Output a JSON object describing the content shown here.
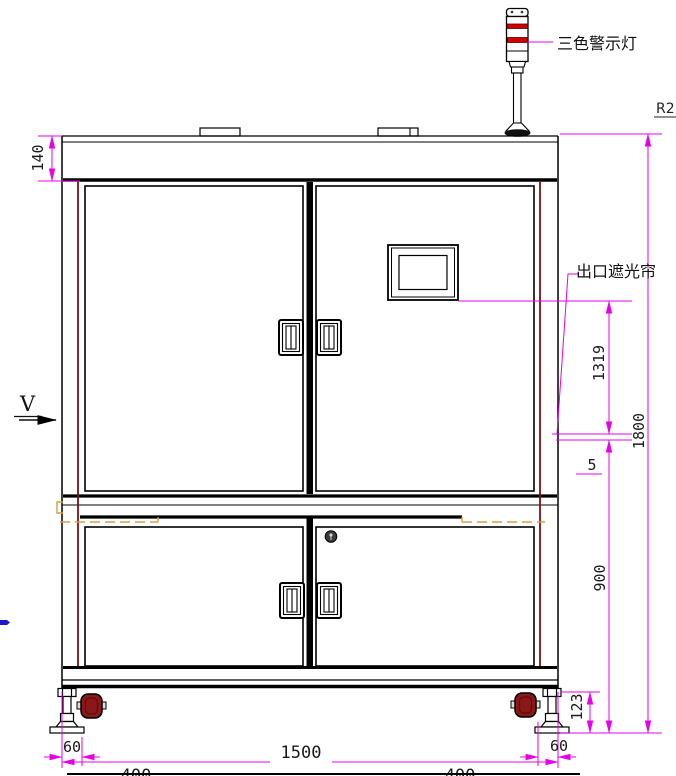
{
  "annotations": {
    "tower_light": "三色警示灯",
    "light_curtain": "出口遮光帘",
    "view_marker": "V",
    "corner_note": "R2"
  },
  "dimensions": {
    "top_band": "140",
    "upper_span": "1319",
    "overall_height": "1800",
    "gap": "5",
    "lower_span": "900",
    "foot_height": "123",
    "left_offset": "60",
    "overall_width": "1500",
    "right_offset": "60",
    "bottom_left_span": "400",
    "bottom_right_span": "400"
  },
  "colors": {
    "dimension_line": "#e800e8",
    "outline": "#000000",
    "door_frame_accent": "#7a1010",
    "caster_fill": "#8b1818",
    "hidden_line_orange": "#d8a040",
    "beacon_red": "#d40000",
    "blue_mark": "#1a1acc"
  }
}
